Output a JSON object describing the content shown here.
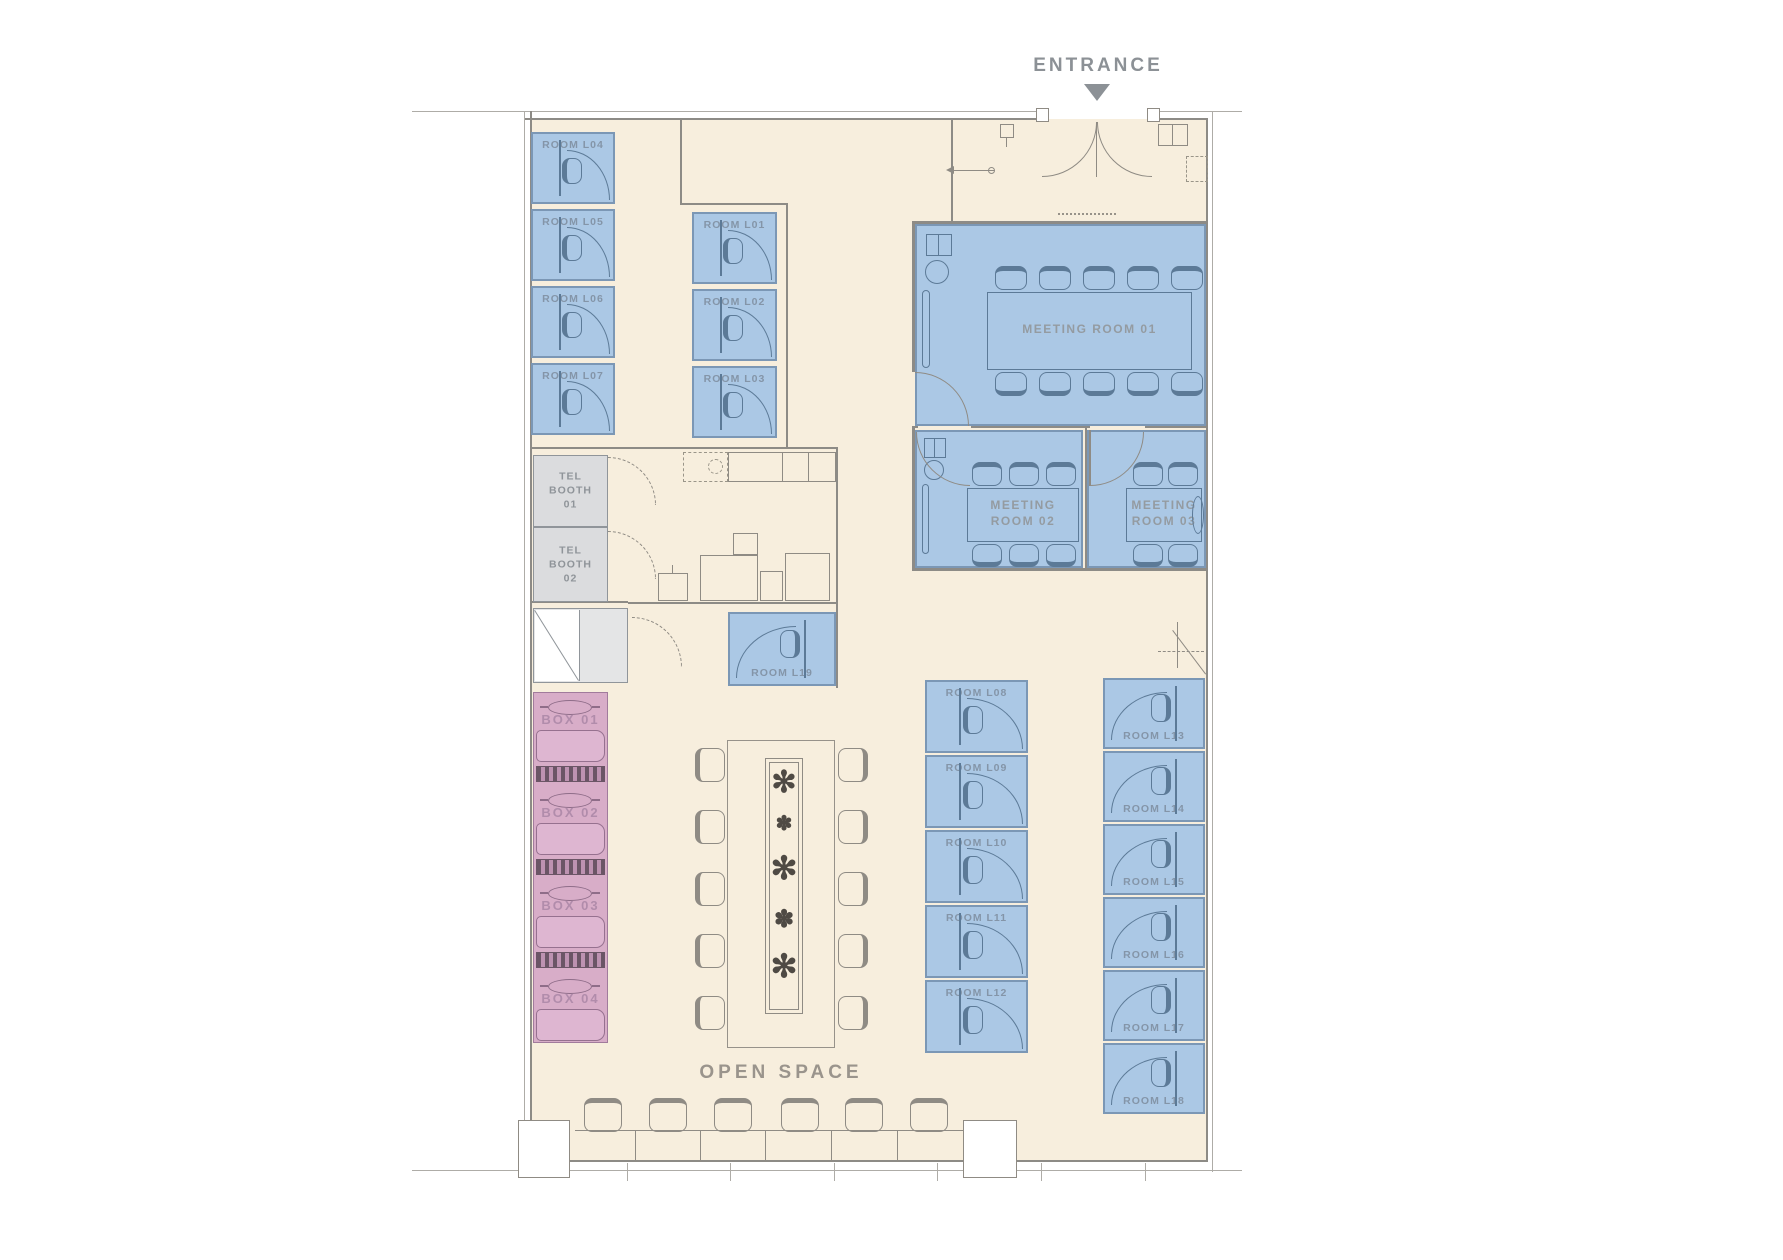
{
  "plan": {
    "entrance": {
      "label": "ENTRANCE"
    },
    "open_space": {
      "label": "OPEN SPACE"
    },
    "rooms": {
      "l01": "ROOM L01",
      "l02": "ROOM L02",
      "l03": "ROOM L03",
      "l04": "ROOM L04",
      "l05": "ROOM L05",
      "l06": "ROOM L06",
      "l07": "ROOM L07",
      "l08": "ROOM L08",
      "l09": "ROOM L09",
      "l10": "ROOM L10",
      "l11": "ROOM L11",
      "l12": "ROOM L12",
      "l13": "ROOM L13",
      "l14": "ROOM L14",
      "l15": "ROOM L15",
      "l16": "ROOM L16",
      "l17": "ROOM L17",
      "l18": "ROOM L18",
      "l19": "ROOM L19"
    },
    "meeting_rooms": {
      "m01": "MEETING ROOM 01",
      "m02": "MEETING\nROOM 02",
      "m03": "MEETING\nROOM 03"
    },
    "tel_booths": {
      "t01": "TEL\nBOOTH\n01",
      "t02": "TEL\nBOOTH\n02"
    },
    "boxes": {
      "b01": "BOX 01",
      "b02": "BOX 02",
      "b03": "BOX 03",
      "b04": "BOX 04"
    },
    "icons": {
      "plant_large": "✻",
      "plant_small": "✽"
    },
    "colors": {
      "floor": "#f7eedd",
      "room_fill": "#abc8e5",
      "room_border": "#7b97b5",
      "booth_fill": "#dbdcde",
      "box_fill": "#d8adc8",
      "wall": "#8d8b86",
      "room_label": "#8495a8",
      "box_label": "#b18cab",
      "entrance_label": "#8c9196"
    }
  }
}
